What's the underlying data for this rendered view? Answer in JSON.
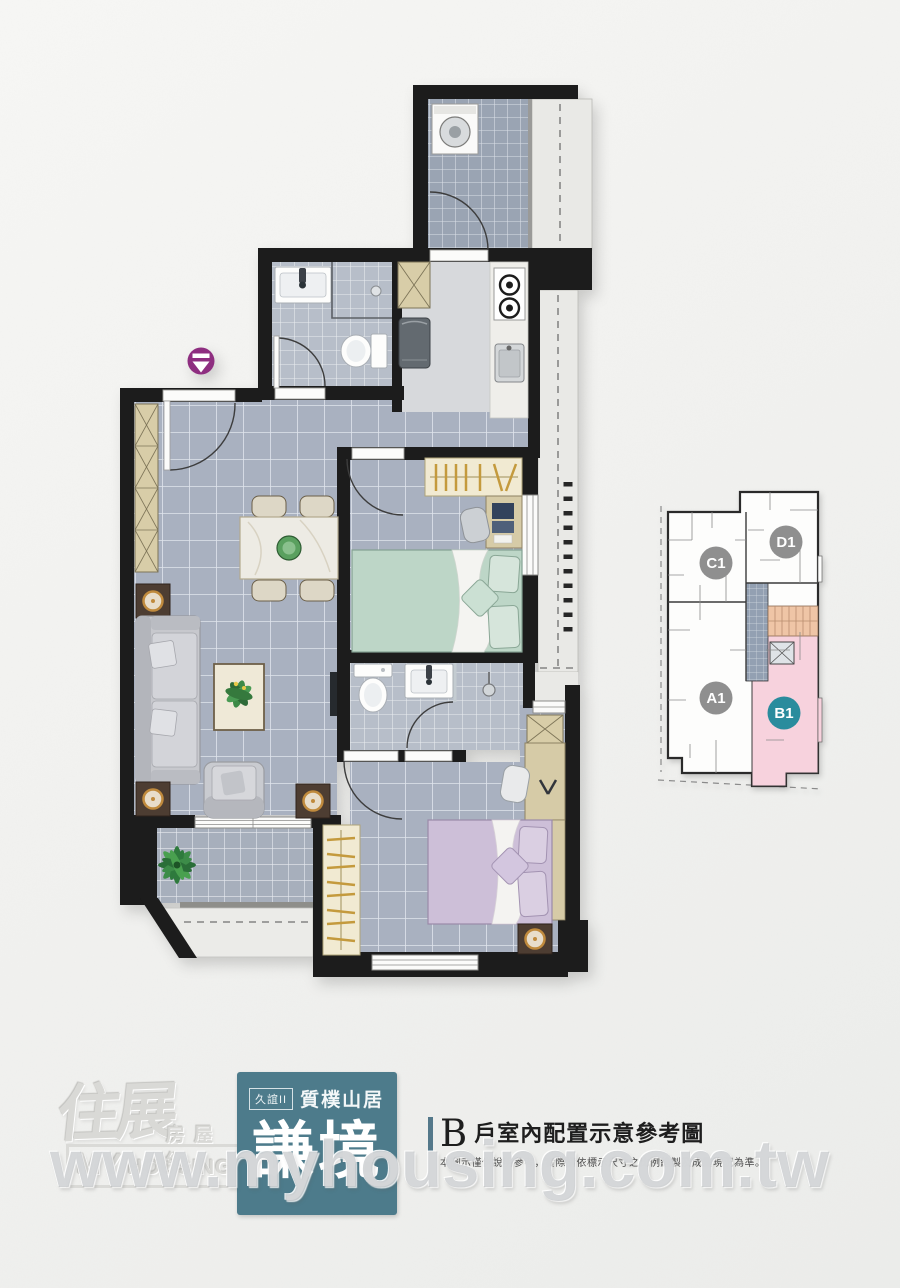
{
  "canvas": {
    "width": 900,
    "height": 1288,
    "background": "#f2f2f0"
  },
  "floorplan": {
    "entry_marker_color": "#8e2d80",
    "wall_color": "#1a1a1a",
    "unit_shown": "B"
  },
  "keyplan": {
    "highlight_color": "#f7d2dd",
    "stair_color": "#efc5a6",
    "units": [
      {
        "id": "C1",
        "badge_color": "#8f8f8f"
      },
      {
        "id": "D1",
        "badge_color": "#8f8f8f"
      },
      {
        "id": "A1",
        "badge_color": "#8f8f8f"
      },
      {
        "id": "B1",
        "badge_color": "#2b8c9d"
      }
    ]
  },
  "logo": {
    "brand_zh": "住展",
    "brand_suffix": "房屋網",
    "brand_en_line1": "MY",
    "brand_en_line2": "HOUSING"
  },
  "brand_box": {
    "bg": "#4d7b8b",
    "tag": "久誼II",
    "series": "質樸山居",
    "name": "謙境"
  },
  "heading": {
    "unit": "B",
    "title": "戶室內配置示意參考圖",
    "disclaimer": "本圖示僅供說明參考，實際請依標示尺寸之比例繪製及成屋現況為準。"
  },
  "watermark": {
    "text": "www.myhousing.com.tw"
  }
}
